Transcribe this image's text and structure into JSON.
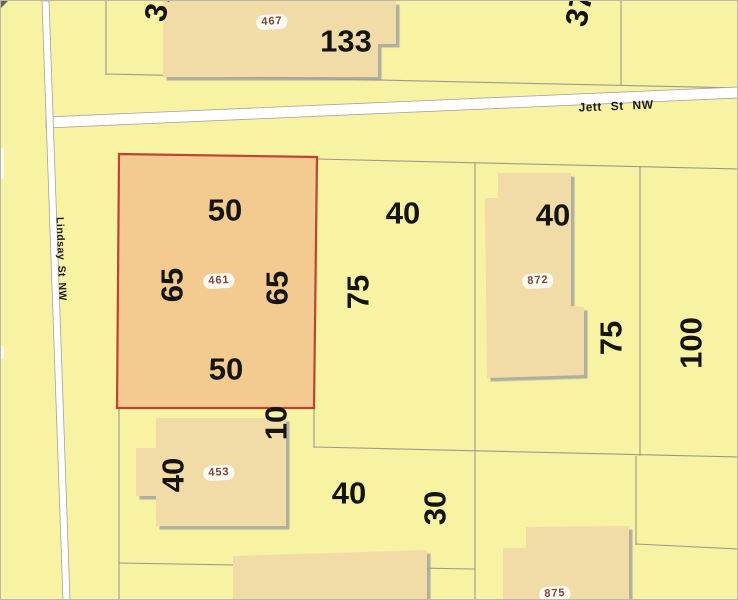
{
  "map_type": "parcel-map",
  "streets": {
    "jett": "Jett St NW",
    "lindsay": "Lindsay St NW"
  },
  "highlighted_parcel": {
    "id": "461",
    "dim_top": "50",
    "dim_bottom": "50",
    "dim_left": "65",
    "dim_right": "65"
  },
  "parcels": {
    "p467": "467",
    "p872": "872",
    "p453": "453",
    "p875": "875"
  },
  "dimensions": {
    "d37_nw": "37",
    "d37_ne": "37",
    "d133": "133",
    "d40_center": "40",
    "d75_center": "75",
    "d40_east": "40",
    "d75_east": "75",
    "d100": "100",
    "d10": "10",
    "d40_sw": "40",
    "d40_south": "40",
    "d30": "30"
  },
  "colors": {
    "background": "#F8F2A3",
    "building_fill": "#F1DCA7",
    "highlight_fill": "#F3CA90",
    "highlight_border": "#BE4430",
    "parcel_line": "#9B9B8C",
    "street_fill": "#FFFFFF",
    "street_casing": "#A3A3A3",
    "dimension_text": "#141414",
    "parcel_id_text": "#7B443C"
  }
}
